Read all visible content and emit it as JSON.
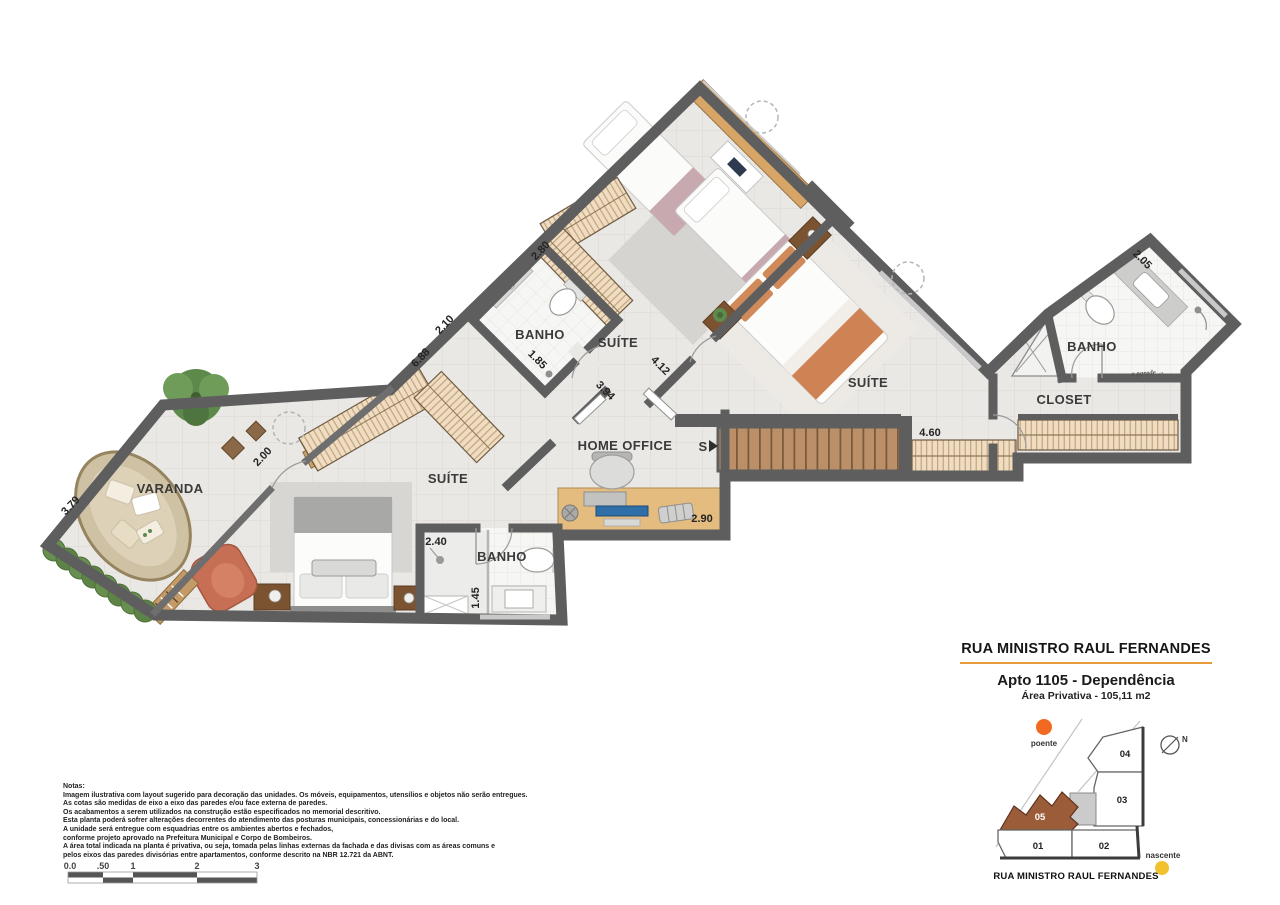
{
  "plan": {
    "rooms": {
      "suite_top": "SUÍTE",
      "suite_right": "SUÍTE",
      "suite_master": "SUÍTE",
      "banho_top": "BANHO",
      "banho_right": "BANHO",
      "banho_bottom": "BANHO",
      "varanda": "VARANDA",
      "home_office": "HOME OFFICE",
      "closet": "CLOSET"
    },
    "stairs_marker": "S",
    "annotation": "a parede →",
    "dimensions": {
      "d_280": "2.80",
      "d_210": "2.10",
      "d_185": "1.85",
      "d_688": "6.88",
      "d_200": "2.00",
      "d_379": "3.79",
      "d_394": "3.94",
      "d_412": "4.12",
      "d_205": "2.05",
      "d_460": "4.60",
      "d_290": "2.90",
      "d_240": "2.40",
      "d_145": "1.45"
    }
  },
  "title_block": {
    "street": "RUA MINISTRO RAUL FERNANDES",
    "apartment": "Apto 1105 - Dependência",
    "area": "Área Privativa - 105,11 m2"
  },
  "site_plan": {
    "west_label": "poente",
    "east_label": "nascente",
    "north_label": "N",
    "street_label": "RUA MINISTRO RAUL FERNANDES",
    "units": {
      "u01": "01",
      "u02": "02",
      "u03": "03",
      "u04": "04",
      "u05": "05"
    },
    "colors": {
      "highlight": "#9b5c3a",
      "west_dot": "#f26a21",
      "east_dot": "#f2c12e",
      "accent_rule": "#e99a3b"
    }
  },
  "notes": {
    "lines": [
      "Notas:",
      "Imagem ilustrativa com layout sugerido para decoração das unidades. Os móveis, equipamentos, utensílios e objetos não serão entregues.",
      "As cotas são medidas de eixo a eixo das paredes e/ou face externa de paredes.",
      "Os acabamentos a serem utilizados na construção estão especificados no memorial descritivo.",
      "Esta planta poderá sofrer alterações decorrentes do atendimento das posturas municipais, concessionárias e do local.",
      "A unidade será entregue com esquadrias entre os ambientes abertos e fechados,",
      "conforme projeto aprovado na Prefeitura Municipal e Corpo de Bombeiros.",
      "A área total indicada na planta é privativa, ou seja, tomada pelas linhas externas da fachada e das divisas com as áreas comuns e",
      "pelos eixos das paredes divisórias entre apartamentos, conforme descrito na NBR 12.721 da ABNT."
    ]
  },
  "scale_bar": {
    "ticks": [
      "0.0",
      ".50",
      "1",
      "2",
      "3"
    ]
  }
}
